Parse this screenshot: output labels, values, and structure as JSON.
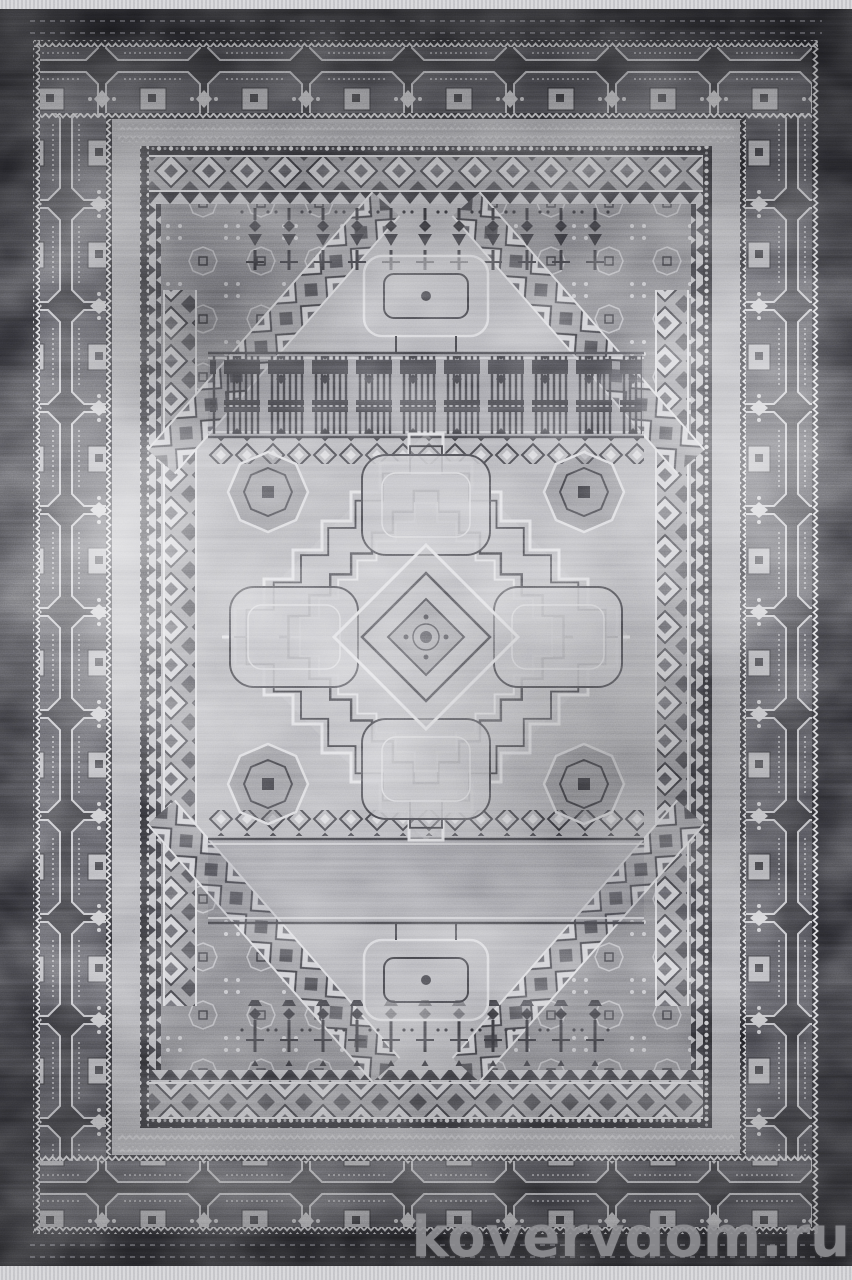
{
  "scene": {
    "type": "product-photo",
    "subject": "vintage-style rectangular area rug, top view",
    "style": "geometric Caucasian / Mamluk medallion design, distressed finish",
    "orientation": "vertical",
    "features": [
      "short white fringe at top and bottom ends",
      "charcoal outer frame band",
      "main border of octagonal cartouches separated by X-motifs",
      "zigzag guard stripes",
      "inner bands of bead rows and diamond chains",
      "octagonal field with corner spandrels cut by diagonal diamond-chain bands",
      "rows of hanging lamp / tower motifs at field ends",
      "comb-and-pillar bands above and below the center",
      "central stepped lozenge medallion with four rounded lobes and concentric diamond core",
      "worn, bleached patches across the pile"
    ]
  },
  "watermark": {
    "text": "kovervdom.ru",
    "color": "#919195"
  },
  "palette": {
    "fringe": "#d7d7da",
    "frame_black": "#1a1a1e",
    "border_ground": "#26262a",
    "border_motif_light": "#c2c2c6",
    "guard_gray": "#a2a2a7",
    "field_light": "#a6a6ab",
    "field_mid": "#8d8d92",
    "motif_dark": "#26262b",
    "motif_light": "#d4d4d8"
  }
}
